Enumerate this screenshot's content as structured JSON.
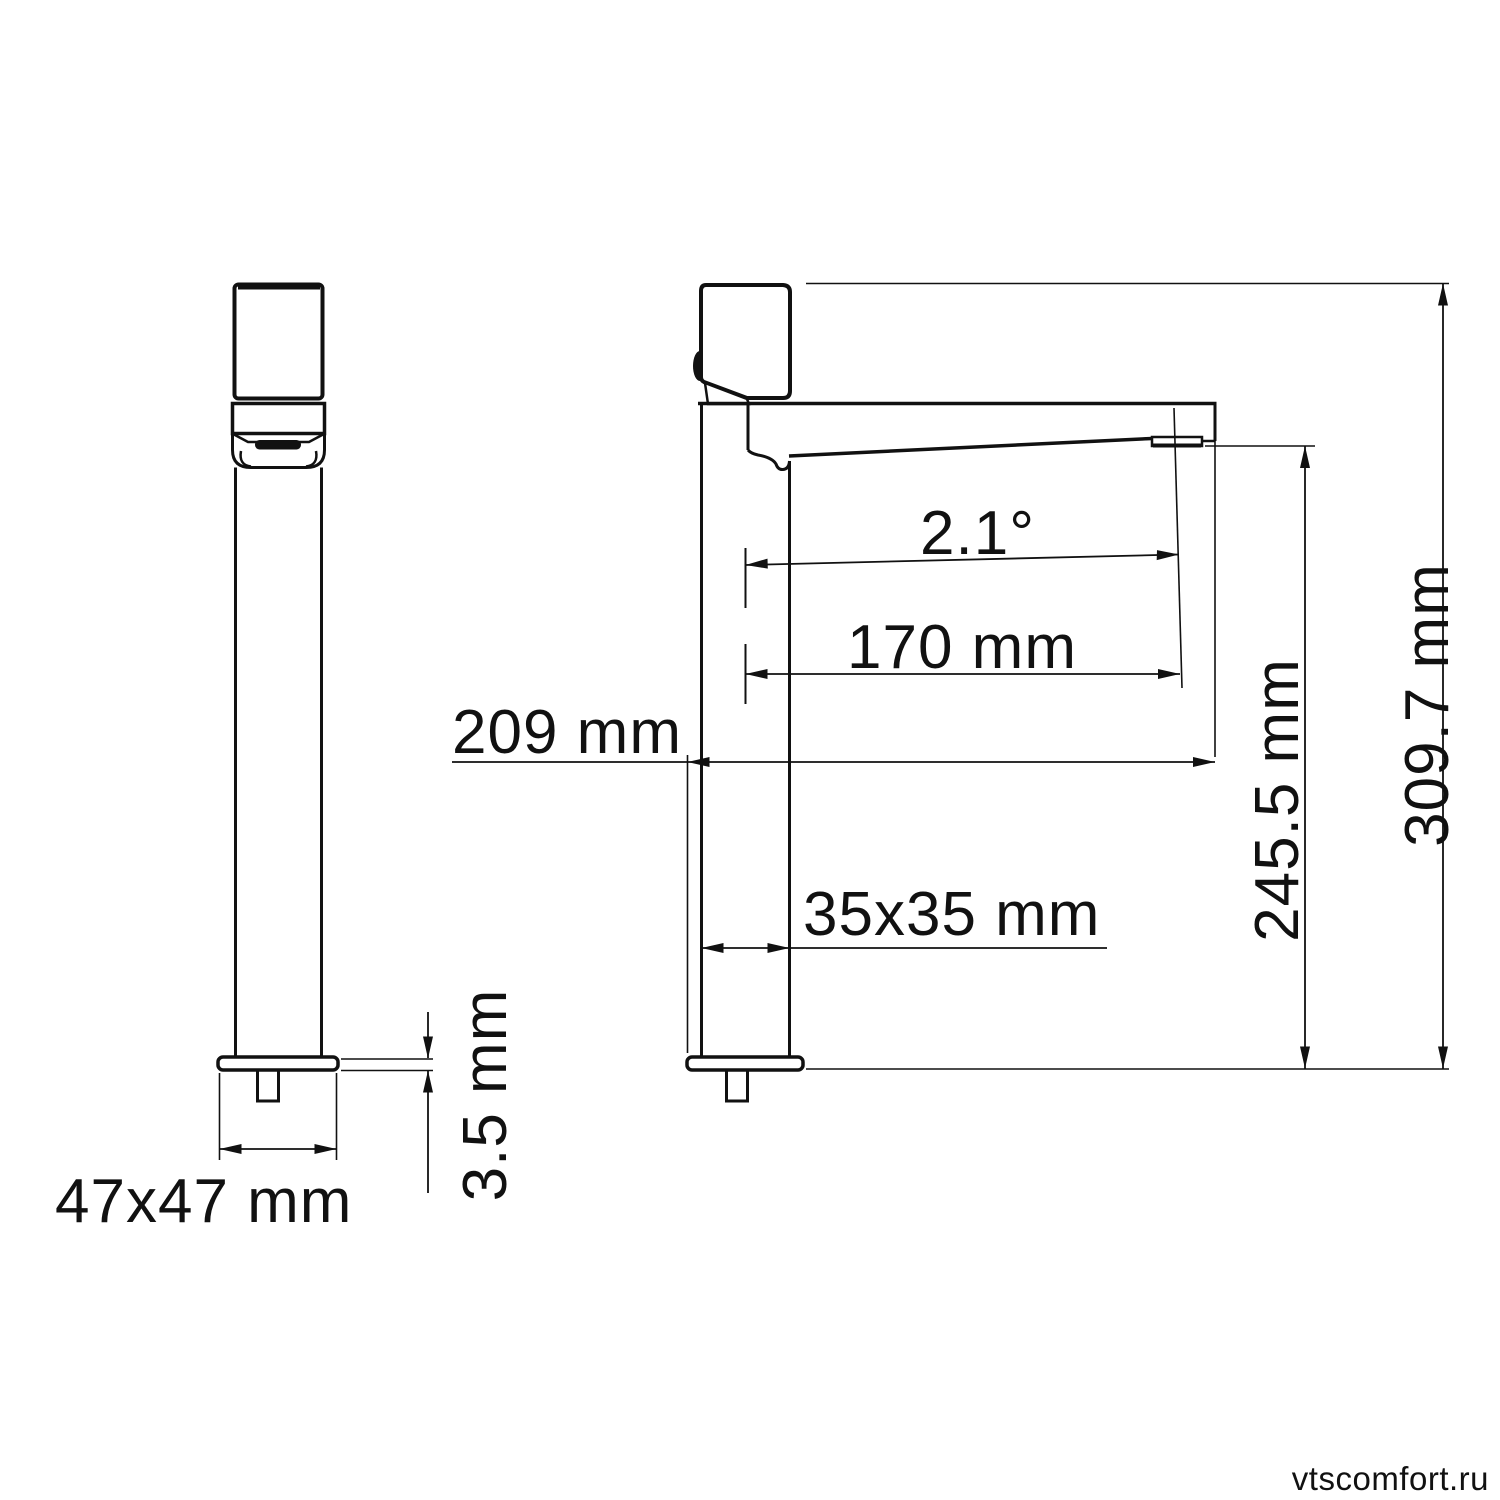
{
  "drawing": {
    "type": "technical-dimensional-drawing",
    "subject": "single-lever tall basin faucet, front and side orthographic views",
    "line_color": "#111111",
    "background_color": "#ffffff",
    "labels": {
      "base_size": "47x47 mm",
      "plate_thickness": "3.5 mm",
      "total_reach": "209 mm",
      "body_section": "35x35 mm",
      "spout_reach": "170 mm",
      "spout_angle": "2.1°",
      "aerator_height": "245.5 mm",
      "total_height": "309.7 mm"
    }
  },
  "watermark": {
    "text": "vtscomfort.ru",
    "color": "#8a8a8a"
  }
}
